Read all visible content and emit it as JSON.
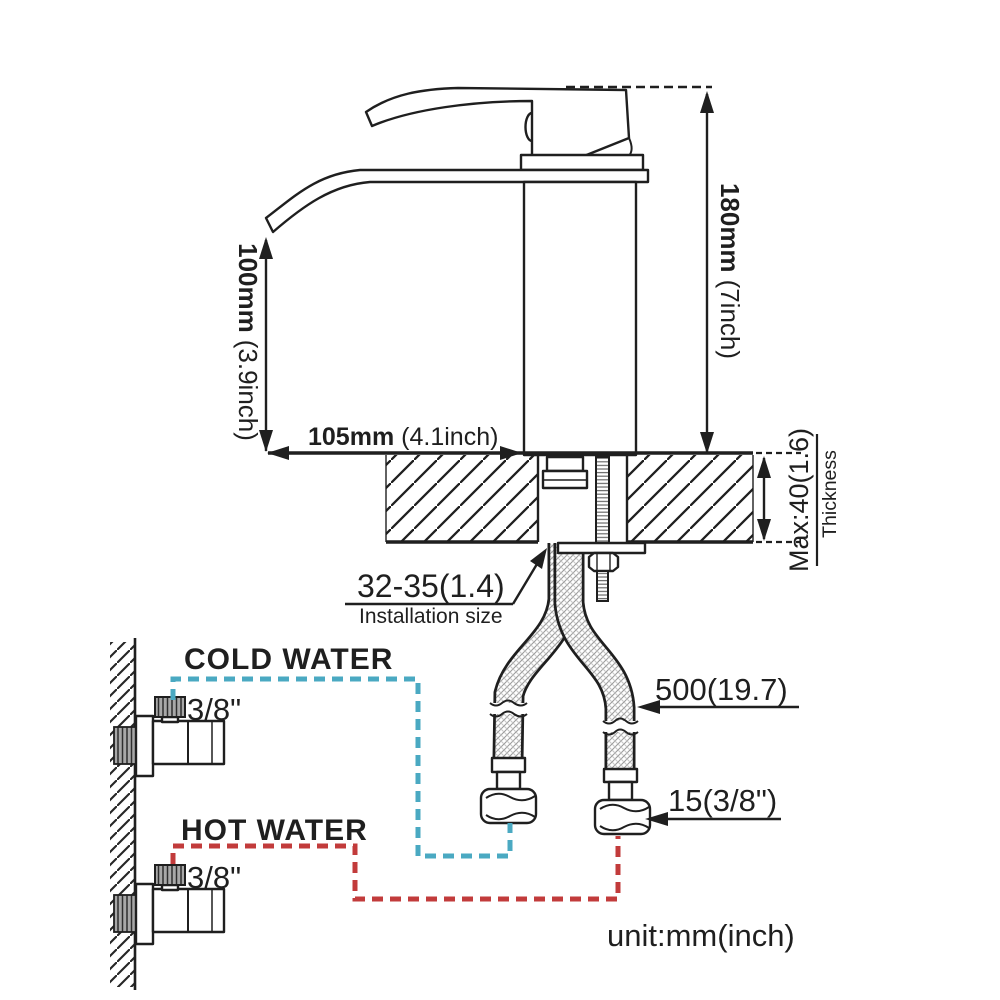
{
  "diagram": {
    "title": "faucet-installation-diagram",
    "unit_note": "unit:mm(inch)",
    "ink": "#1f1f1f",
    "dimensions": {
      "height": {
        "value": "180mm",
        "alt": "(7inch)"
      },
      "spout_height": {
        "value": "100mm",
        "alt": "(3.9inch)"
      },
      "reach": {
        "value": "105mm",
        "alt": "(4.1inch)"
      },
      "counter_thickness": {
        "value": "Max:40(1.6)",
        "caption": "Thickness"
      },
      "installation_hole": {
        "value": "32-35(1.4)",
        "caption": "Installation size"
      },
      "hose_length": {
        "value": "500(19.7)"
      },
      "hose_connector": {
        "value": "15(3/8\")"
      }
    },
    "supply": {
      "cold": {
        "label": "COLD WATER",
        "size": "3/8\"",
        "color": "#4aa9c2"
      },
      "hot": {
        "label": "HOT WATER",
        "size": "3/8\"",
        "color": "#a63a3a",
        "line_color": "#c23b3b"
      }
    }
  }
}
